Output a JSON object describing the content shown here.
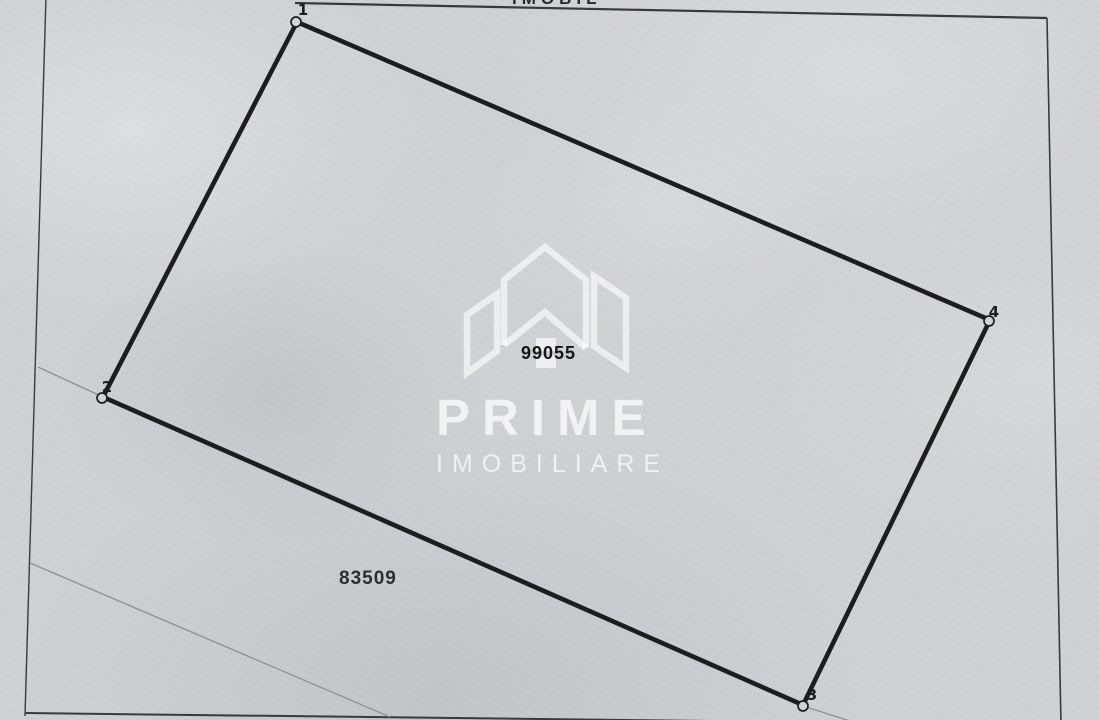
{
  "document": {
    "header_fragment": "IMOBIL"
  },
  "plan": {
    "parcel_number": "99055",
    "adjacent_parcel_number": "83509",
    "corner_labels": [
      "1",
      "2",
      "3",
      "4"
    ]
  },
  "watermark": {
    "brand_name": "PRIME",
    "brand_subtitle": "IMOBILIARE",
    "logo": "house-buildings-outline"
  },
  "colors": {
    "paper": "#d1d2d5",
    "boundary_line": "#1d1d1d",
    "frame_line": "#3a3a3c",
    "faint_line": "#8f8f93",
    "watermark_white": "rgba(255,255,255,0.72)",
    "printed_text": "#161616"
  }
}
